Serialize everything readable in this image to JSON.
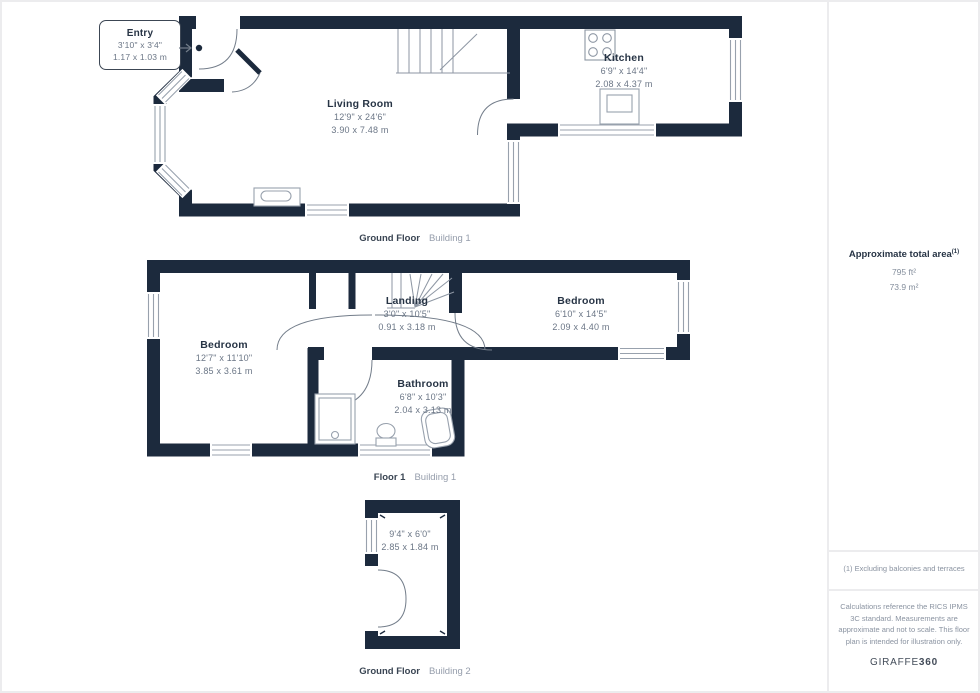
{
  "rooms": {
    "entry": {
      "name": "Entry",
      "dims_ft": "3'10\" x 3'4\"",
      "dims_m": "1.17 x 1.03 m"
    },
    "living_room": {
      "name": "Living Room",
      "dims_ft": "12'9\" x 24'6\"",
      "dims_m": "3.90 x 7.48 m"
    },
    "kitchen": {
      "name": "Kitchen",
      "dims_ft": "6'9\" x 14'4\"",
      "dims_m": "2.08 x 4.37 m"
    },
    "bedroom_left": {
      "name": "Bedroom",
      "dims_ft": "12'7\" x 11'10\"",
      "dims_m": "3.85 x 3.61 m"
    },
    "landing": {
      "name": "Landing",
      "dims_ft": "3'0\" x 10'5\"",
      "dims_m": "0.91 x 3.18 m"
    },
    "bedroom_right": {
      "name": "Bedroom",
      "dims_ft": "6'10\" x 14'5\"",
      "dims_m": "2.09 x 4.40 m"
    },
    "bathroom": {
      "name": "Bathroom",
      "dims_ft": "6'8\" x 10'3\"",
      "dims_m": "2.04 x 3.13 m"
    },
    "building2_room": {
      "dims_ft": "9'4\" x 6'0\"",
      "dims_m": "2.85 x 1.84 m"
    }
  },
  "captions": {
    "gf_b1": {
      "floor": "Ground Floor",
      "building": "Building 1"
    },
    "f1_b1": {
      "floor": "Floor 1",
      "building": "Building 1"
    },
    "gf_b2": {
      "floor": "Ground Floor",
      "building": "Building 2"
    }
  },
  "panel": {
    "total_area_label": "Approximate total area",
    "total_area_marker": "(1)",
    "area_ft": "795 ft²",
    "area_m": "73.9 m²",
    "footnote": "(1) Excluding balconies and terraces",
    "disclaimer": "Calculations reference the RICS IPMS 3C standard. Measurements are approximate and not to scale. This floor plan is intended for illustration only.",
    "brand_name": "GIRAFFE",
    "brand_suffix": "360"
  },
  "colors": {
    "wall": "#1c2a3d",
    "room_name_text": "#273445",
    "dims_text": "#6b7686",
    "window_line": "#98a1ad",
    "door_arc": "#737d8a",
    "divider": "#ececee"
  }
}
